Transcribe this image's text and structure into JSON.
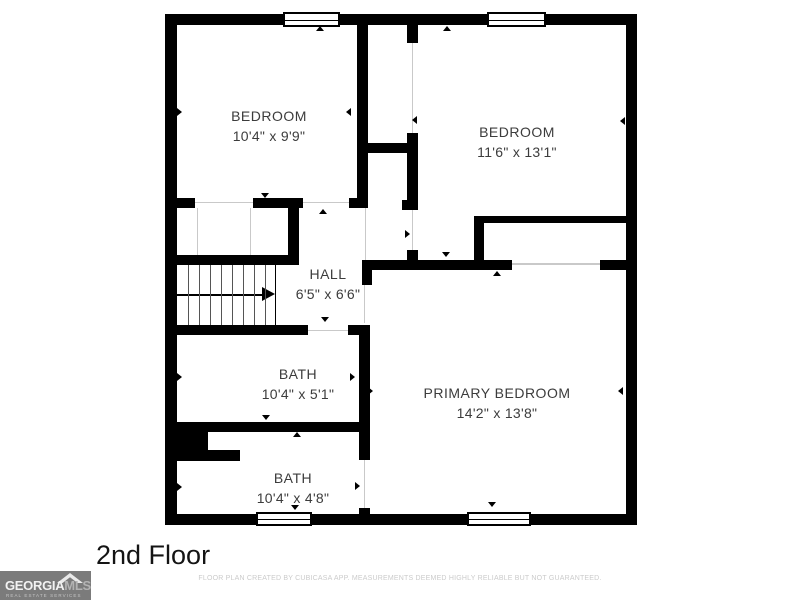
{
  "floor_plan": {
    "rooms": {
      "bedroom1": {
        "name": "BEDROOM",
        "dims": "10'4\" x 9'9\""
      },
      "bedroom2": {
        "name": "BEDROOM",
        "dims": "11'6\" x 13'1\""
      },
      "hall": {
        "name": "HALL",
        "dims": "6'5\" x 6'6\""
      },
      "bath1": {
        "name": "BATH",
        "dims": "10'4\" x 5'1\""
      },
      "primary": {
        "name": "PRIMARY BEDROOM",
        "dims": "14'2\" x 13'8\""
      },
      "bath2": {
        "name": "BATH",
        "dims": "10'4\" x 4'8\""
      }
    },
    "window_count": 4,
    "stairs_direction": "up-right"
  },
  "footer": {
    "floor_label": "2nd Floor",
    "disclaimer": "FLOOR PLAN CREATED BY CUBICASA APP. MEASUREMENTS DEEMED HIGHLY RELIABLE BUT NOT GUARANTEED."
  },
  "logo": {
    "brand_primary": "GEORGIA",
    "brand_secondary": "MLS",
    "tagline": "REAL ESTATE SERVICES"
  },
  "colors": {
    "wall": "#000000",
    "room_label": "#3c3c3c",
    "disclaimer_text": "#cbcbcb",
    "logo_background": "#7b7b7b",
    "logo_text_primary": "#f2f2f2",
    "logo_text_secondary": "#b3b3b3"
  }
}
